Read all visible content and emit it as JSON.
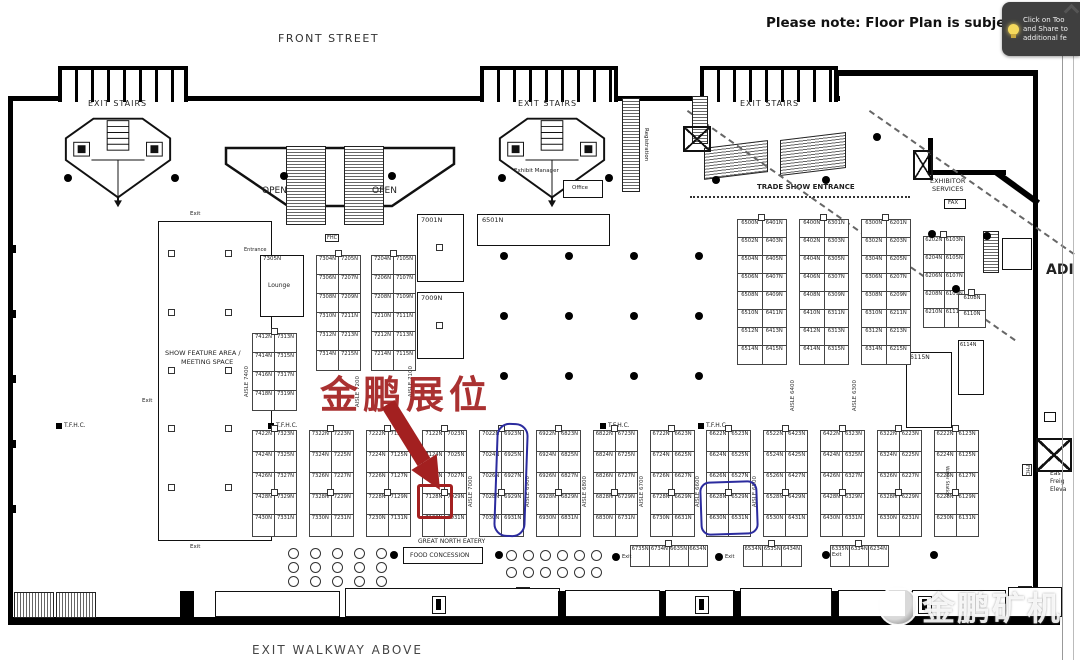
{
  "viewer": {
    "note": "Please note: Floor Plan is subject to",
    "tooltip": {
      "icon": "lightbulb-icon",
      "lines": [
        "Click on Too",
        "and Share to",
        "additional fe"
      ]
    },
    "watermark": "金鹏矿机",
    "right_edge_text": "ADI"
  },
  "streets": {
    "top": "FRONT STREET",
    "bottom": "EXIT WALKWAY ABOVE"
  },
  "annotation": {
    "booth_callout": "金鹏展位",
    "red_boxed_booth": "7128N",
    "red_color": "#a32020",
    "blue_color": "#2b2b9e"
  },
  "labels": {
    "exit_stairs": "EXIT STAIRS",
    "open": "OPEN",
    "trade_show_entrance": "TRADE SHOW ENTRANCE",
    "exhibitor_services_line1": "EXHIBITOR",
    "exhibitor_services_line2": "SERVICES",
    "fax": "FAX",
    "show_feature_line1": "SHOW FEATURE AREA /",
    "show_feature_line2": "MEETING SPACE",
    "lounge": "Lounge",
    "tfhc": "T.F.H.C.",
    "fhc": "FHC",
    "great_north_eatery": "GREAT NORTH EATERY",
    "food_concession": "FOOD CONCESSION",
    "exit": "Exit",
    "entrance": "Entrance",
    "registration": "Registration",
    "exhibit_manager": "Exhibit Manager",
    "office": "Office",
    "water_station": "Water Station",
    "east_freight_elevator": [
      "Eas",
      "Freig",
      "Eleva"
    ]
  },
  "aisle_labels": [
    "AISLE 7400",
    "AISLE 7200",
    "AISLE 7100",
    "AISLE 7000",
    "AISLE 6900",
    "AISLE 6800",
    "AISLE 6700",
    "AISLE 6600",
    "AISLE 6500",
    "AISLE 6400",
    "AISLE 6300"
  ],
  "booths": {
    "featured": {
      "lounge_id": "7305N",
      "b7001": "7001N",
      "b7009": "7009N",
      "b6501": "6501N",
      "b6115": "6115N",
      "b6114": "6114N"
    },
    "upper_left_columns": [
      [
        [
          "7304N",
          "7205N"
        ],
        [
          "7306N",
          "7207N"
        ],
        [
          "7308N",
          "7209N"
        ],
        [
          "7310N",
          "7211N"
        ],
        [
          "7312N",
          "7213N"
        ],
        [
          "7314N",
          "7215N"
        ]
      ],
      [
        [
          "7204N",
          "7105N"
        ],
        [
          "7206N",
          "7107N"
        ],
        [
          "7208N",
          "7109N"
        ],
        [
          "7210N",
          "7111N"
        ],
        [
          "7212N",
          "7113N"
        ],
        [
          "7214N",
          "7115N"
        ]
      ]
    ],
    "upper_left_side_column": [
      [
        "7412N",
        "7313N"
      ],
      [
        "7414N",
        "7315N"
      ],
      [
        "7416N",
        "7317N"
      ],
      [
        "7418N",
        "7319N"
      ]
    ],
    "upper_right_columns": [
      [
        [
          "6500N",
          "6401N"
        ],
        [
          "6502N",
          "6403N"
        ],
        [
          "6504N",
          "6405N"
        ],
        [
          "6506N",
          "6407N"
        ],
        [
          "6508N",
          "6409N"
        ],
        [
          "6510N",
          "6411N"
        ],
        [
          "6512N",
          "6413N"
        ],
        [
          "6514N",
          "6415N"
        ]
      ],
      [
        [
          "6400N",
          "6301N"
        ],
        [
          "6402N",
          "6303N"
        ],
        [
          "6404N",
          "6305N"
        ],
        [
          "6406N",
          "6307N"
        ],
        [
          "6408N",
          "6309N"
        ],
        [
          "6410N",
          "6311N"
        ],
        [
          "6412N",
          "6313N"
        ],
        [
          "6414N",
          "6315N"
        ]
      ],
      [
        [
          "6300N",
          "6201N"
        ],
        [
          "6302N",
          "6203N"
        ],
        [
          "6304N",
          "6205N"
        ],
        [
          "6306N",
          "6207N"
        ],
        [
          "6308N",
          "6209N"
        ],
        [
          "6310N",
          "6211N"
        ],
        [
          "6312N",
          "6213N"
        ],
        [
          "6314N",
          "6215N"
        ]
      ]
    ],
    "far_right_column": [
      [
        "6202N",
        "6103N"
      ],
      [
        "6204N",
        "6105N"
      ],
      [
        "6206N",
        "6107N"
      ],
      [
        "6208N",
        "6109N"
      ],
      [
        "6210N",
        "6111N"
      ]
    ],
    "right_edge_small_column": [
      [
        "6108N"
      ],
      [
        "6110N"
      ]
    ],
    "lower_columns": [
      [
        [
          "7422N",
          "7323N"
        ],
        [
          "7424N",
          "7325N"
        ],
        [
          "7426N",
          "7327N"
        ],
        [
          "7428N",
          "7329N"
        ],
        [
          "7430N",
          "7331N"
        ]
      ],
      [
        [
          "7322N",
          "7223N"
        ],
        [
          "7324N",
          "7225N"
        ],
        [
          "7326N",
          "7227N"
        ],
        [
          "7328N",
          "7229N"
        ],
        [
          "7330N",
          "7231N"
        ]
      ],
      [
        [
          "7222N",
          "7123N"
        ],
        [
          "7224N",
          "7125N"
        ],
        [
          "7226N",
          "7127N"
        ],
        [
          "7228N",
          "7129N"
        ],
        [
          "7230N",
          "7131N"
        ]
      ],
      [
        [
          "7122N",
          "7023N"
        ],
        [
          "7124N",
          "7025N"
        ],
        [
          "7126N",
          "7027N"
        ],
        [
          "7128N",
          "7029N"
        ],
        [
          "7130N",
          "7031N"
        ]
      ],
      [
        [
          "7022N",
          "6923N"
        ],
        [
          "7024N",
          "6925N"
        ],
        [
          "7026N",
          "6927N"
        ],
        [
          "7028N",
          "6929N"
        ],
        [
          "7030N",
          "6931N"
        ]
      ],
      [
        [
          "6922N",
          "6823N"
        ],
        [
          "6924N",
          "6825N"
        ],
        [
          "6926N",
          "6827N"
        ],
        [
          "6928N",
          "6829N"
        ],
        [
          "6930N",
          "6831N"
        ]
      ],
      [
        [
          "6822N",
          "6723N"
        ],
        [
          "6824N",
          "6725N"
        ],
        [
          "6826N",
          "6727N"
        ],
        [
          "6828N",
          "6729N"
        ],
        [
          "6830N",
          "6731N"
        ]
      ],
      [
        [
          "6722N",
          "6623N"
        ],
        [
          "6724N",
          "6625N"
        ],
        [
          "6726N",
          "6627N"
        ],
        [
          "6728N",
          "6629N"
        ],
        [
          "6730N",
          "6631N"
        ]
      ],
      [
        [
          "6622N",
          "6523N"
        ],
        [
          "6624N",
          "6525N"
        ],
        [
          "6626N",
          "6527N"
        ],
        [
          "6628N",
          "6529N"
        ],
        [
          "6630N",
          "6531N"
        ]
      ],
      [
        [
          "6522N",
          "6423N"
        ],
        [
          "6524N",
          "6425N"
        ],
        [
          "6526N",
          "6427N"
        ],
        [
          "6528N",
          "6429N"
        ],
        [
          "6530N",
          "6431N"
        ]
      ],
      [
        [
          "6422N",
          "6323N"
        ],
        [
          "6424N",
          "6325N"
        ],
        [
          "6426N",
          "6327N"
        ],
        [
          "6428N",
          "6329N"
        ],
        [
          "6430N",
          "6331N"
        ]
      ],
      [
        [
          "6322N",
          "6223N"
        ],
        [
          "6324N",
          "6225N"
        ],
        [
          "6326N",
          "6227N"
        ],
        [
          "6328N",
          "6229N"
        ],
        [
          "6330N",
          "6231N"
        ]
      ],
      [
        [
          "6222N",
          "6123N"
        ],
        [
          "6224N",
          "6125N"
        ],
        [
          "6226N",
          "6127N"
        ],
        [
          "6228N",
          "6129N"
        ],
        [
          "6230N",
          "6131N"
        ]
      ]
    ],
    "bottom_row_groups": [
      [
        "6735N",
        "6734N",
        "6635N",
        "6634N"
      ],
      [
        "6534N",
        "6535N",
        "6434N"
      ],
      [
        "6335N",
        "6334N",
        "6234N"
      ]
    ],
    "blue_circled_column_cells": [
      "6923N",
      "6925N",
      "6927N",
      "6929N",
      "6931N"
    ],
    "blue_circled_block_cells": [
      "6628N",
      "6529N",
      "6630N",
      "6531N"
    ]
  }
}
